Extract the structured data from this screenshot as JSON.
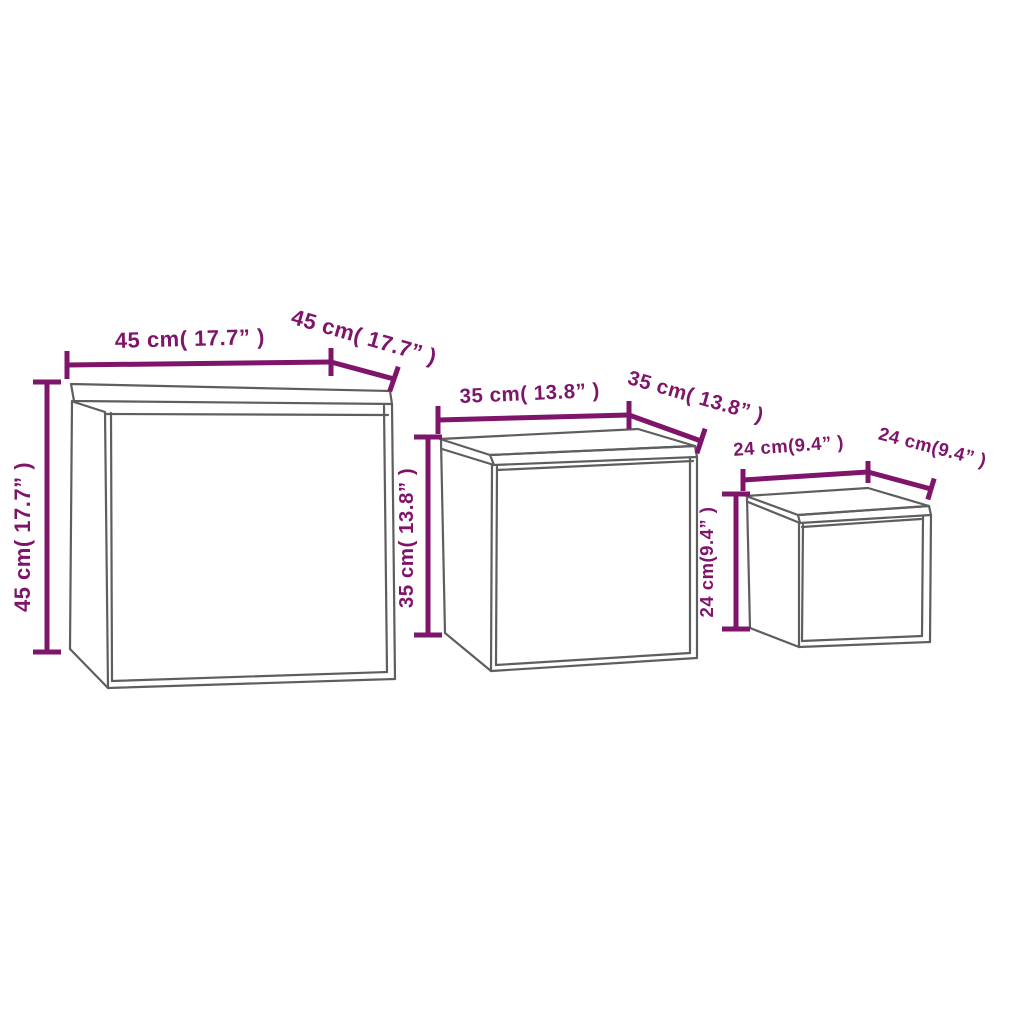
{
  "figure": {
    "kind": "product-dimension-diagram",
    "units": [
      "cm",
      "inch"
    ]
  },
  "colors": {
    "dimension": "#7F156B",
    "outline": "#5E5E5E",
    "background": "#FFFFFF"
  },
  "tables": [
    {
      "name": "large-table",
      "width_cm": 45,
      "width_in": 17.7,
      "depth_cm": 45,
      "depth_in": 17.7,
      "height_cm": 45,
      "height_in": 17.7,
      "width_label": "45 cm( 17.7” )",
      "depth_label": "45 cm( 17.7” )",
      "height_label": "45 cm( 17.7” )"
    },
    {
      "name": "medium-table",
      "width_cm": 35,
      "width_in": 13.8,
      "depth_cm": 35,
      "depth_in": 13.8,
      "height_cm": 35,
      "height_in": 13.8,
      "width_label": "35 cm( 13.8” )",
      "depth_label": "35 cm( 13.8” )",
      "height_label": "35 cm( 13.8” )"
    },
    {
      "name": "small-table",
      "width_cm": 24,
      "width_in": 9.4,
      "depth_cm": 24,
      "depth_in": 9.4,
      "height_cm": 24,
      "height_in": 9.4,
      "width_label": "24 cm(9.4” )",
      "depth_label": "24 cm(9.4” )",
      "height_label": "24 cm(9.4” )"
    }
  ]
}
